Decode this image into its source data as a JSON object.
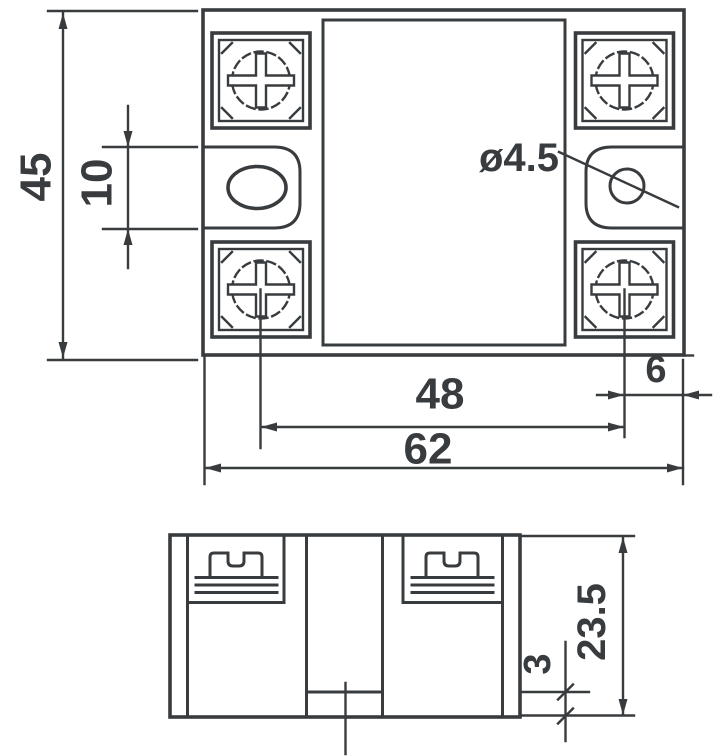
{
  "drawing": {
    "line_color": "#393c3f",
    "background": "#ffffff",
    "dimensions": {
      "body_height": "45",
      "slot_spacing": "10",
      "hole_diameter": "ø4.5",
      "screw_spacing": "48",
      "body_width": "62",
      "edge_offset": "6",
      "depth": "23.5",
      "base_step": "3"
    }
  }
}
